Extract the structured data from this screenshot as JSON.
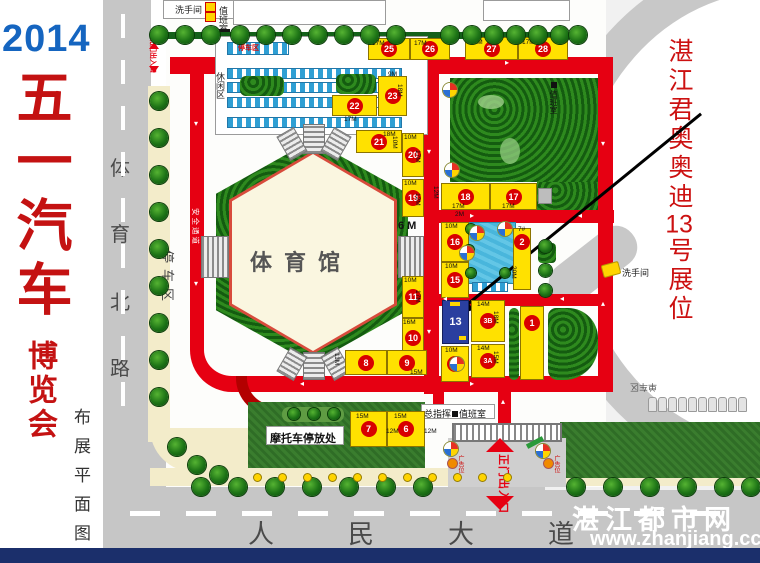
{
  "left_panel": {
    "year": "2014",
    "title": "五一汽车",
    "subtitle": "博览会",
    "note": "布展平面图"
  },
  "west_road": {
    "name": "体育北路",
    "name_chars": [
      "体",
      "育",
      "北",
      "路"
    ],
    "gate_label": "北门出入口",
    "parking_label": "停车区",
    "safety_label": "安全通道"
  },
  "south_road": {
    "name": "人民大道",
    "name_chars": [
      "人",
      "民",
      "大",
      "道"
    ]
  },
  "annotation": {
    "line1": "湛江君奥奥迪",
    "line2": "13",
    "line3": "号展位"
  },
  "stadium": {
    "name": "体育馆"
  },
  "labels": {
    "leisure": "休闲区",
    "canopy_parking": "停车区",
    "restroom_top": "洗手间",
    "restroom_right": "洗手间",
    "duty_top": "值班室",
    "duty_right": "值班室",
    "command": "总指挥",
    "duty_gate": "值班室",
    "moto": "摩托车停放处",
    "main_gate": "正门出入口",
    "bike_area": "单车区",
    "ad_left": "广告位",
    "ad_right": "广告位",
    "w6": "6 M"
  },
  "watermark": {
    "name": "湛江都市网",
    "url": "www.zhanjiang.cc"
  },
  "colors": {
    "road_red": "#e60012",
    "booth_yellow": "#ffe100",
    "booth13_blue": "#2a3f9f",
    "circle_red": "#d80000",
    "title_red": "#c41212",
    "year_blue": "#1565c0",
    "annotation_red": "#cc1111"
  },
  "booths": [
    {
      "no": "25",
      "x": 368,
      "y": 38,
      "w": 42,
      "h": 22
    },
    {
      "no": "26",
      "x": 410,
      "y": 38,
      "w": 40,
      "h": 22
    },
    {
      "no": "27",
      "x": 465,
      "y": 37,
      "w": 53,
      "h": 23
    },
    {
      "no": "28",
      "x": 518,
      "y": 37,
      "w": 50,
      "h": 23
    },
    {
      "no": "22",
      "x": 332,
      "y": 95,
      "w": 45,
      "h": 21
    },
    {
      "no": "23",
      "x": 378,
      "y": 76,
      "w": 29,
      "h": 40
    },
    {
      "no": "21",
      "x": 356,
      "y": 130,
      "w": 46,
      "h": 23
    },
    {
      "no": "20",
      "x": 402,
      "y": 133,
      "w": 22,
      "h": 44
    },
    {
      "no": "19",
      "x": 402,
      "y": 179,
      "w": 22,
      "h": 38
    },
    {
      "no": "11",
      "x": 402,
      "y": 276,
      "w": 22,
      "h": 42
    },
    {
      "no": "10",
      "x": 402,
      "y": 318,
      "w": 22,
      "h": 40
    },
    {
      "no": "8",
      "x": 345,
      "y": 350,
      "w": 42,
      "h": 25
    },
    {
      "no": "9",
      "x": 387,
      "y": 350,
      "w": 40,
      "h": 25
    },
    {
      "no": "7",
      "x": 350,
      "y": 411,
      "w": 37,
      "h": 36
    },
    {
      "no": "6",
      "x": 387,
      "y": 411,
      "w": 38,
      "h": 36
    },
    {
      "no": "18",
      "x": 441,
      "y": 183,
      "w": 49,
      "h": 27
    },
    {
      "no": "17",
      "x": 490,
      "y": 183,
      "w": 47,
      "h": 27
    },
    {
      "no": "16",
      "x": 441,
      "y": 222,
      "w": 28,
      "h": 40
    },
    {
      "no": "15",
      "x": 441,
      "y": 262,
      "w": 28,
      "h": 36
    },
    {
      "no": "13",
      "x": 442,
      "y": 300,
      "w": 27,
      "h": 44,
      "blue": true
    },
    {
      "no": "3B",
      "x": 471,
      "y": 300,
      "w": 34,
      "h": 42
    },
    {
      "no": "3A",
      "x": 471,
      "y": 344,
      "w": 34,
      "h": 34
    },
    {
      "no": "12",
      "x": 441,
      "y": 346,
      "w": 28,
      "h": 36
    },
    {
      "no": "2",
      "x": 513,
      "y": 228,
      "w": 18,
      "h": 62
    },
    {
      "no": "1",
      "x": 520,
      "y": 306,
      "w": 24,
      "h": 74
    }
  ],
  "dims": [
    [
      "17M",
      372,
      40,
      0
    ],
    [
      "17M",
      414,
      40,
      0
    ],
    [
      "17M",
      470,
      39,
      0
    ],
    [
      "17M",
      522,
      39,
      0
    ],
    [
      "17M",
      344,
      116,
      0
    ],
    [
      "9M",
      388,
      71,
      0
    ],
    [
      "18M",
      403,
      84,
      90
    ],
    [
      "18M",
      383,
      131,
      0
    ],
    [
      "10M",
      398,
      136,
      90
    ],
    [
      "10M",
      404,
      134,
      0
    ],
    [
      "17M",
      421,
      150,
      90
    ],
    [
      "10M",
      404,
      180,
      0
    ],
    [
      "12M",
      421,
      193,
      90
    ],
    [
      "10M",
      404,
      277,
      0
    ],
    [
      "17M",
      421,
      290,
      90
    ],
    [
      "16M",
      403,
      319,
      0
    ],
    [
      "11M",
      340,
      353,
      90
    ],
    [
      "15M",
      410,
      369,
      0
    ],
    [
      "15M",
      356,
      413,
      0
    ],
    [
      "12M",
      386,
      428,
      0
    ],
    [
      "15M",
      394,
      413,
      0
    ],
    [
      "12M",
      424,
      428,
      0
    ],
    [
      "12M",
      439,
      186,
      90
    ],
    [
      "17M",
      452,
      203,
      0
    ],
    [
      "17M",
      502,
      203,
      0
    ],
    [
      "10M",
      445,
      223,
      0
    ],
    [
      "10M",
      445,
      263,
      0
    ],
    [
      "14M",
      477,
      301,
      0
    ],
    [
      "18M",
      499,
      311,
      90
    ],
    [
      "14M",
      477,
      345,
      0
    ],
    [
      "15M",
      499,
      351,
      90
    ],
    [
      "10M",
      445,
      347,
      0
    ],
    [
      "20M",
      517,
      266,
      90
    ],
    [
      "2M",
      455,
      211,
      0
    ],
    [
      "7#",
      518,
      226,
      0
    ]
  ]
}
